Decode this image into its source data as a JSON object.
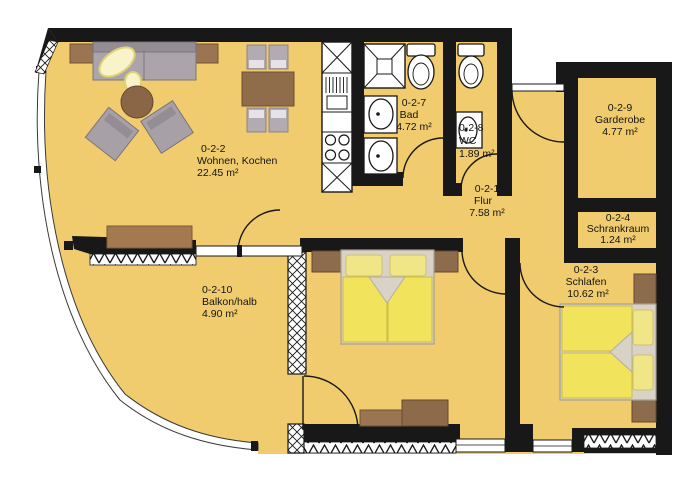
{
  "plan": {
    "type": "apartment-floor-plan",
    "rooms": [
      {
        "id": "0-2-2",
        "name": "Wohnen, Kochen",
        "area": "22.45 m²"
      },
      {
        "id": "0-2-7",
        "name": "Bad",
        "area": "4.72 m²"
      },
      {
        "id": "0-2-8",
        "name": "WC",
        "area": "1.89 m²"
      },
      {
        "id": "0-2-9",
        "name": "Garderobe",
        "area": "4.77 m²"
      },
      {
        "id": "0-2-4",
        "name": "Schrankraum",
        "area": "1.24 m²"
      },
      {
        "id": "0-2-1",
        "name": "Flur",
        "area": "7.58 m²"
      },
      {
        "id": "0-2-3",
        "name": "Schlafen",
        "area": "10.62 m²"
      },
      {
        "id": "0-2-10",
        "name": "Balkon/halb",
        "area": "4.90 m²"
      }
    ],
    "colors": {
      "floor": "#f1cc6e",
      "wall": "#181818",
      "bed_linen": "#f1e35c",
      "pillow": "#f0e688",
      "bed_frame": "#d9d3c7",
      "furniture_wood": "#8f6c4a",
      "furniture_gray": "#a7a1a7",
      "fixture_white": "#ffffff"
    }
  }
}
